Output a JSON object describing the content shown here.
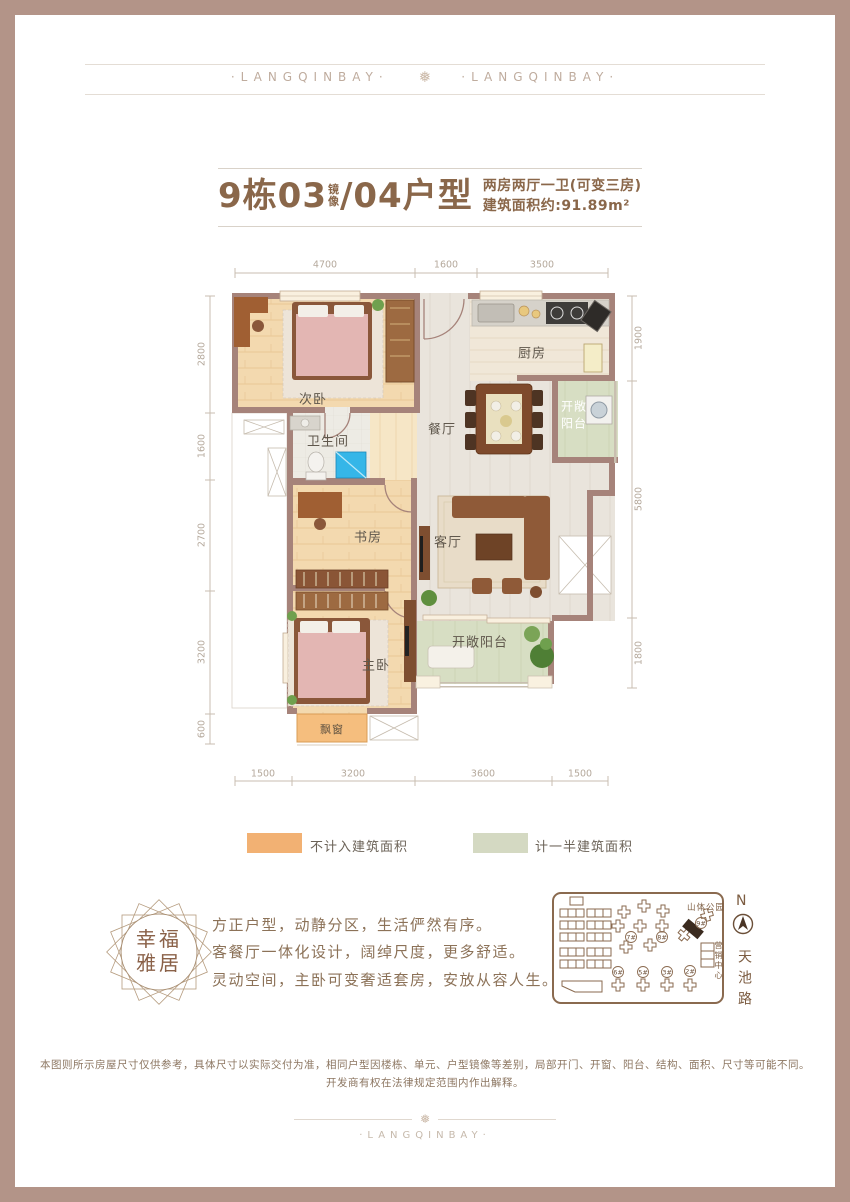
{
  "colors": {
    "frame": "#B39488",
    "accent_brown": "#8A674A",
    "wall": "#A6837A",
    "wood_floor": "#F3D9AF",
    "tile_floor": "#E9E4DC",
    "balcony_green": "#D7DEC3",
    "bay_orange": "#F5BE7E",
    "legend_orange": "#F2B173",
    "legend_green": "#D4D9C2",
    "map_brown": "#8A6A4F"
  },
  "header": {
    "wordmark_left": "·LANGQINBAY·",
    "wordmark_right": "·LANGQINBAY·",
    "snowflake": "❅"
  },
  "title": {
    "building": "9栋03",
    "mirror_top": "镜",
    "mirror_bottom": "像",
    "unit": "/04户型",
    "subtitle_line1": "两房两厅一卫(可变三房)",
    "subtitle_line2": "建筑面积约:91.89m²"
  },
  "plan": {
    "dims": {
      "top": [
        "4700",
        "1600",
        "3500"
      ],
      "bottom": [
        "1500",
        "3200",
        "3600",
        "1500"
      ],
      "left": [
        "2800",
        "1600",
        "2700",
        "3200",
        "600"
      ],
      "right": [
        "1900",
        "5800",
        "1800"
      ]
    },
    "rooms": {
      "secondary_bedroom": "次卧",
      "bathroom": "卫生间",
      "study": "书房",
      "master_bedroom": "主卧",
      "bay_window": "飘窗",
      "dining": "餐厅",
      "living": "客厅",
      "kitchen": "厨房",
      "balcony_right_line1": "开敞",
      "balcony_right_line2": "阳台",
      "balcony_bottom": "开敞阳台"
    }
  },
  "legend": {
    "items": [
      {
        "label": "不计入建筑面积",
        "color": "#F2B173"
      },
      {
        "label": "计一半建筑面积",
        "color": "#D4D9C2"
      }
    ]
  },
  "seal": {
    "line1": "幸福",
    "line2": "雅居"
  },
  "description": {
    "line1": "方正户型，动静分区，生活俨然有序。",
    "line2": "客餐厅一体化设计，阔绰尺度，更多舒适。",
    "line3": "灵动空间，主卧可变奢适套房，安放从容人生。"
  },
  "sitemap": {
    "park": "山体公园",
    "marketing_center": "营销中心",
    "north": "N",
    "road": "天池路",
    "buildings": [
      "7#",
      "8#",
      "9#",
      "6#",
      "5#",
      "3#",
      "2#"
    ]
  },
  "disclaimer": {
    "line1": "本图则所示房屋尺寸仅供参考，具体尺寸以实际交付为准，相同户型因楼栋、单元、户型镜像等差别，局部开门、开窗、阳台、结构、面积、尺寸等可能不同。",
    "line2": "开发商有权在法律规定范围内作出解释。"
  },
  "footer": {
    "wordmark": "·LANGQINBAY·",
    "snowflake": "❅"
  }
}
